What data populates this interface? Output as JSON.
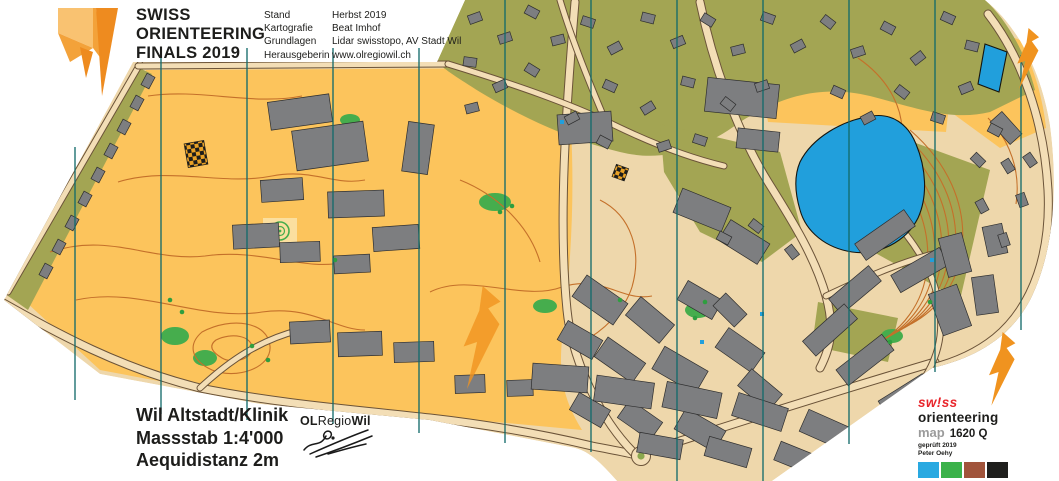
{
  "header": {
    "title_lines": [
      "SWISS",
      "ORIENTEERING",
      "FINALS 2019"
    ],
    "credits": [
      {
        "label": "Stand",
        "value": "Herbst 2019"
      },
      {
        "label": "Kartografie",
        "value": "Beat Imhof"
      },
      {
        "label": "Grundlagen",
        "value": "Lidar swisstopo, AV Stadt Wil"
      },
      {
        "label": "Herausgeberin",
        "value": "www.olregiowil.ch"
      }
    ]
  },
  "footer": {
    "map_name": "Wil Altstadt/Klinik",
    "scale_label": "Massstab 1:4'000",
    "equidistance_label": "Aequidistanz 2m",
    "club_name_parts": {
      "first": "OL",
      "middle": "Regio",
      "last": "Wil"
    }
  },
  "certification": {
    "brand_top": "sw!ss",
    "brand_bottom": "orienteering",
    "map_word": "map",
    "map_number": "1620 Q",
    "checked_line": "geprüft 2019",
    "checker_name": "Peter Oehy",
    "swatches": [
      "#29a9e1",
      "#3bb24a",
      "#a1543b",
      "#1f1f1d"
    ]
  },
  "map": {
    "region_label": "Orienteering map Wil Altstadt/Klinik",
    "palette": {
      "open_yellow": "#fcc45c",
      "pale_yellow": "#fbdf9f",
      "olive_green": "#a3a553",
      "urban_tan": "#eed7ab",
      "road_fill": "#f3deb6",
      "road_casing": "#6b5338",
      "building_gray": "#7d7e80",
      "building_outline": "#2e2e2e",
      "water_blue": "#219fdc",
      "contour_orange": "#c4702a",
      "vegetation_green": "#46ad4d",
      "north_line_teal": "#136b6b",
      "accent_orange": "#f0931f",
      "swiss_red": "#e8262c"
    }
  }
}
